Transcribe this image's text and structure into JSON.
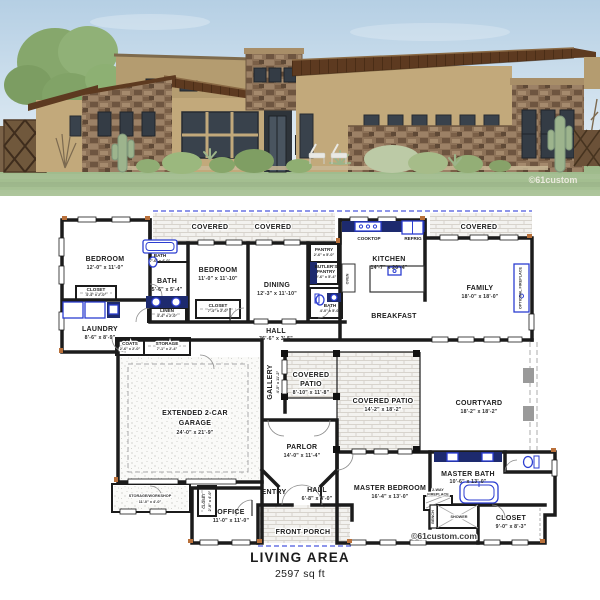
{
  "page": {
    "background": "#ffffff"
  },
  "colors": {
    "wall": "#1b1b1b",
    "fixture_blue": "#2c3ed1",
    "counter_navy": "#1d2a6e",
    "dashed_blue": "#4a58dd",
    "accent_orange": "#b9703a",
    "sky": "#bad2e6",
    "lawn": "#a3bf90",
    "roof_brown": "#5d3a20",
    "stucco_tan": "#c2a97b",
    "stone_brown": "#8d7258"
  },
  "watermarks": {
    "render": "©61custom",
    "plan": "©61custom.com"
  },
  "footer": {
    "title": "LIVING AREA",
    "area": "2597 sq ft"
  },
  "plan": {
    "labels": {
      "covered": "COVERED"
    },
    "fixtures": {
      "cooktop": "COOKTOP",
      "refrig": "REFRIG",
      "oven": "OVEN",
      "optional_fireplace": "OPTIONAL FIREPLACE",
      "fireplace_l1": "2-WAY",
      "fireplace_l2": "FIREPLACE",
      "bench": "BENCH",
      "shower": "SHOWER"
    },
    "rooms": {
      "bedroom1": {
        "name": "BEDROOM",
        "dims": "12'-0\" x 11'-0\""
      },
      "bath1": {
        "name": "BATH",
        "dims": "7'-6\" x 4'-0\""
      },
      "closet1": {
        "name": "CLOSET",
        "dims": "4'-4\" x 2'-0\""
      },
      "bath2": {
        "name": "BATH",
        "dims": "5'-6\" x 5'-4\""
      },
      "linen": {
        "name": "LINEN",
        "dims": "4'-4\" x 2'-0\""
      },
      "bedroom2": {
        "name": "BEDROOM",
        "dims": "11'-0\" x 11'-10\""
      },
      "closet2": {
        "name": "CLOSET",
        "dims": "7'-4\" x 2'-0\""
      },
      "laundry": {
        "name": "LAUNDRY",
        "dims": "8'-6\" x 8'-9\""
      },
      "coats": {
        "name": "COATS",
        "dims": "2'-6\" x 2'-0\""
      },
      "storage": {
        "name": "STORAGE",
        "dims": "7'-1\" x 2'-4\""
      },
      "hall": {
        "name": "HALL",
        "dims": "36'-6\" x 3'-5\""
      },
      "gallery": {
        "name": "GALLERY",
        "dims": "4'-5\" x 11'-2\""
      },
      "dining": {
        "name": "DINING",
        "dims": "12'-3\" x 11'-10\""
      },
      "pantry": {
        "name": "PANTRY",
        "dims": "2'-6\" x 5'-0\""
      },
      "butlers": {
        "name": "BUTLER'S",
        "name2": "PANTRY",
        "dims": "2'-6\" x 5'-4\""
      },
      "bath3": {
        "name": "BATH",
        "dims": "4'-0\" x 5'-0\""
      },
      "kitchen": {
        "name": "KITCHEN",
        "dims": "14'-7\" x 20'-4\""
      },
      "breakfast": {
        "name": "BREAKFAST"
      },
      "family": {
        "name": "FAMILY",
        "dims": "18'-0\" x 18'-0\""
      },
      "courtyard": {
        "name": "COURTYARD",
        "dims": "18'-2\" x 18'-2\""
      },
      "patio1": {
        "name": "COVERED",
        "name2": "PATIO",
        "dims": "8'-10\" x 11'-8\""
      },
      "patio2": {
        "name": "COVERED PATIO",
        "dims": "14'-2\" x 18'-2\""
      },
      "garage": {
        "name": "EXTENDED 2-CAR",
        "name2": "GARAGE",
        "dims": "24'-0\" x 21'-9\""
      },
      "workshop": {
        "name": "STORAGE/WORKSHOP",
        "dims": "11'-0\" x 4'-0\""
      },
      "closet_office": {
        "name": "CLOSET",
        "dims": "2'-8\" x 4'-0\""
      },
      "office": {
        "name": "OFFICE",
        "dims": "11'-0\" x 11'-0\""
      },
      "entry": {
        "name": "ENTRY"
      },
      "hall_front": {
        "name": "HALL",
        "dims": "6'-8\" x 4'-0\""
      },
      "front_porch": {
        "name": "FRONT PORCH"
      },
      "parlor": {
        "name": "PARLOR",
        "dims": "14'-0\" x 11'-4\""
      },
      "master_bedroom": {
        "name": "MASTER BEDROOM",
        "dims": "16'-4\" x 13'-0\""
      },
      "master_bath": {
        "name": "MASTER BATH",
        "dims": "10'-6\" x 13'-0\""
      },
      "closet_master": {
        "name": "CLOSET",
        "dims": "9'-0\" x 8'-3\""
      }
    }
  }
}
